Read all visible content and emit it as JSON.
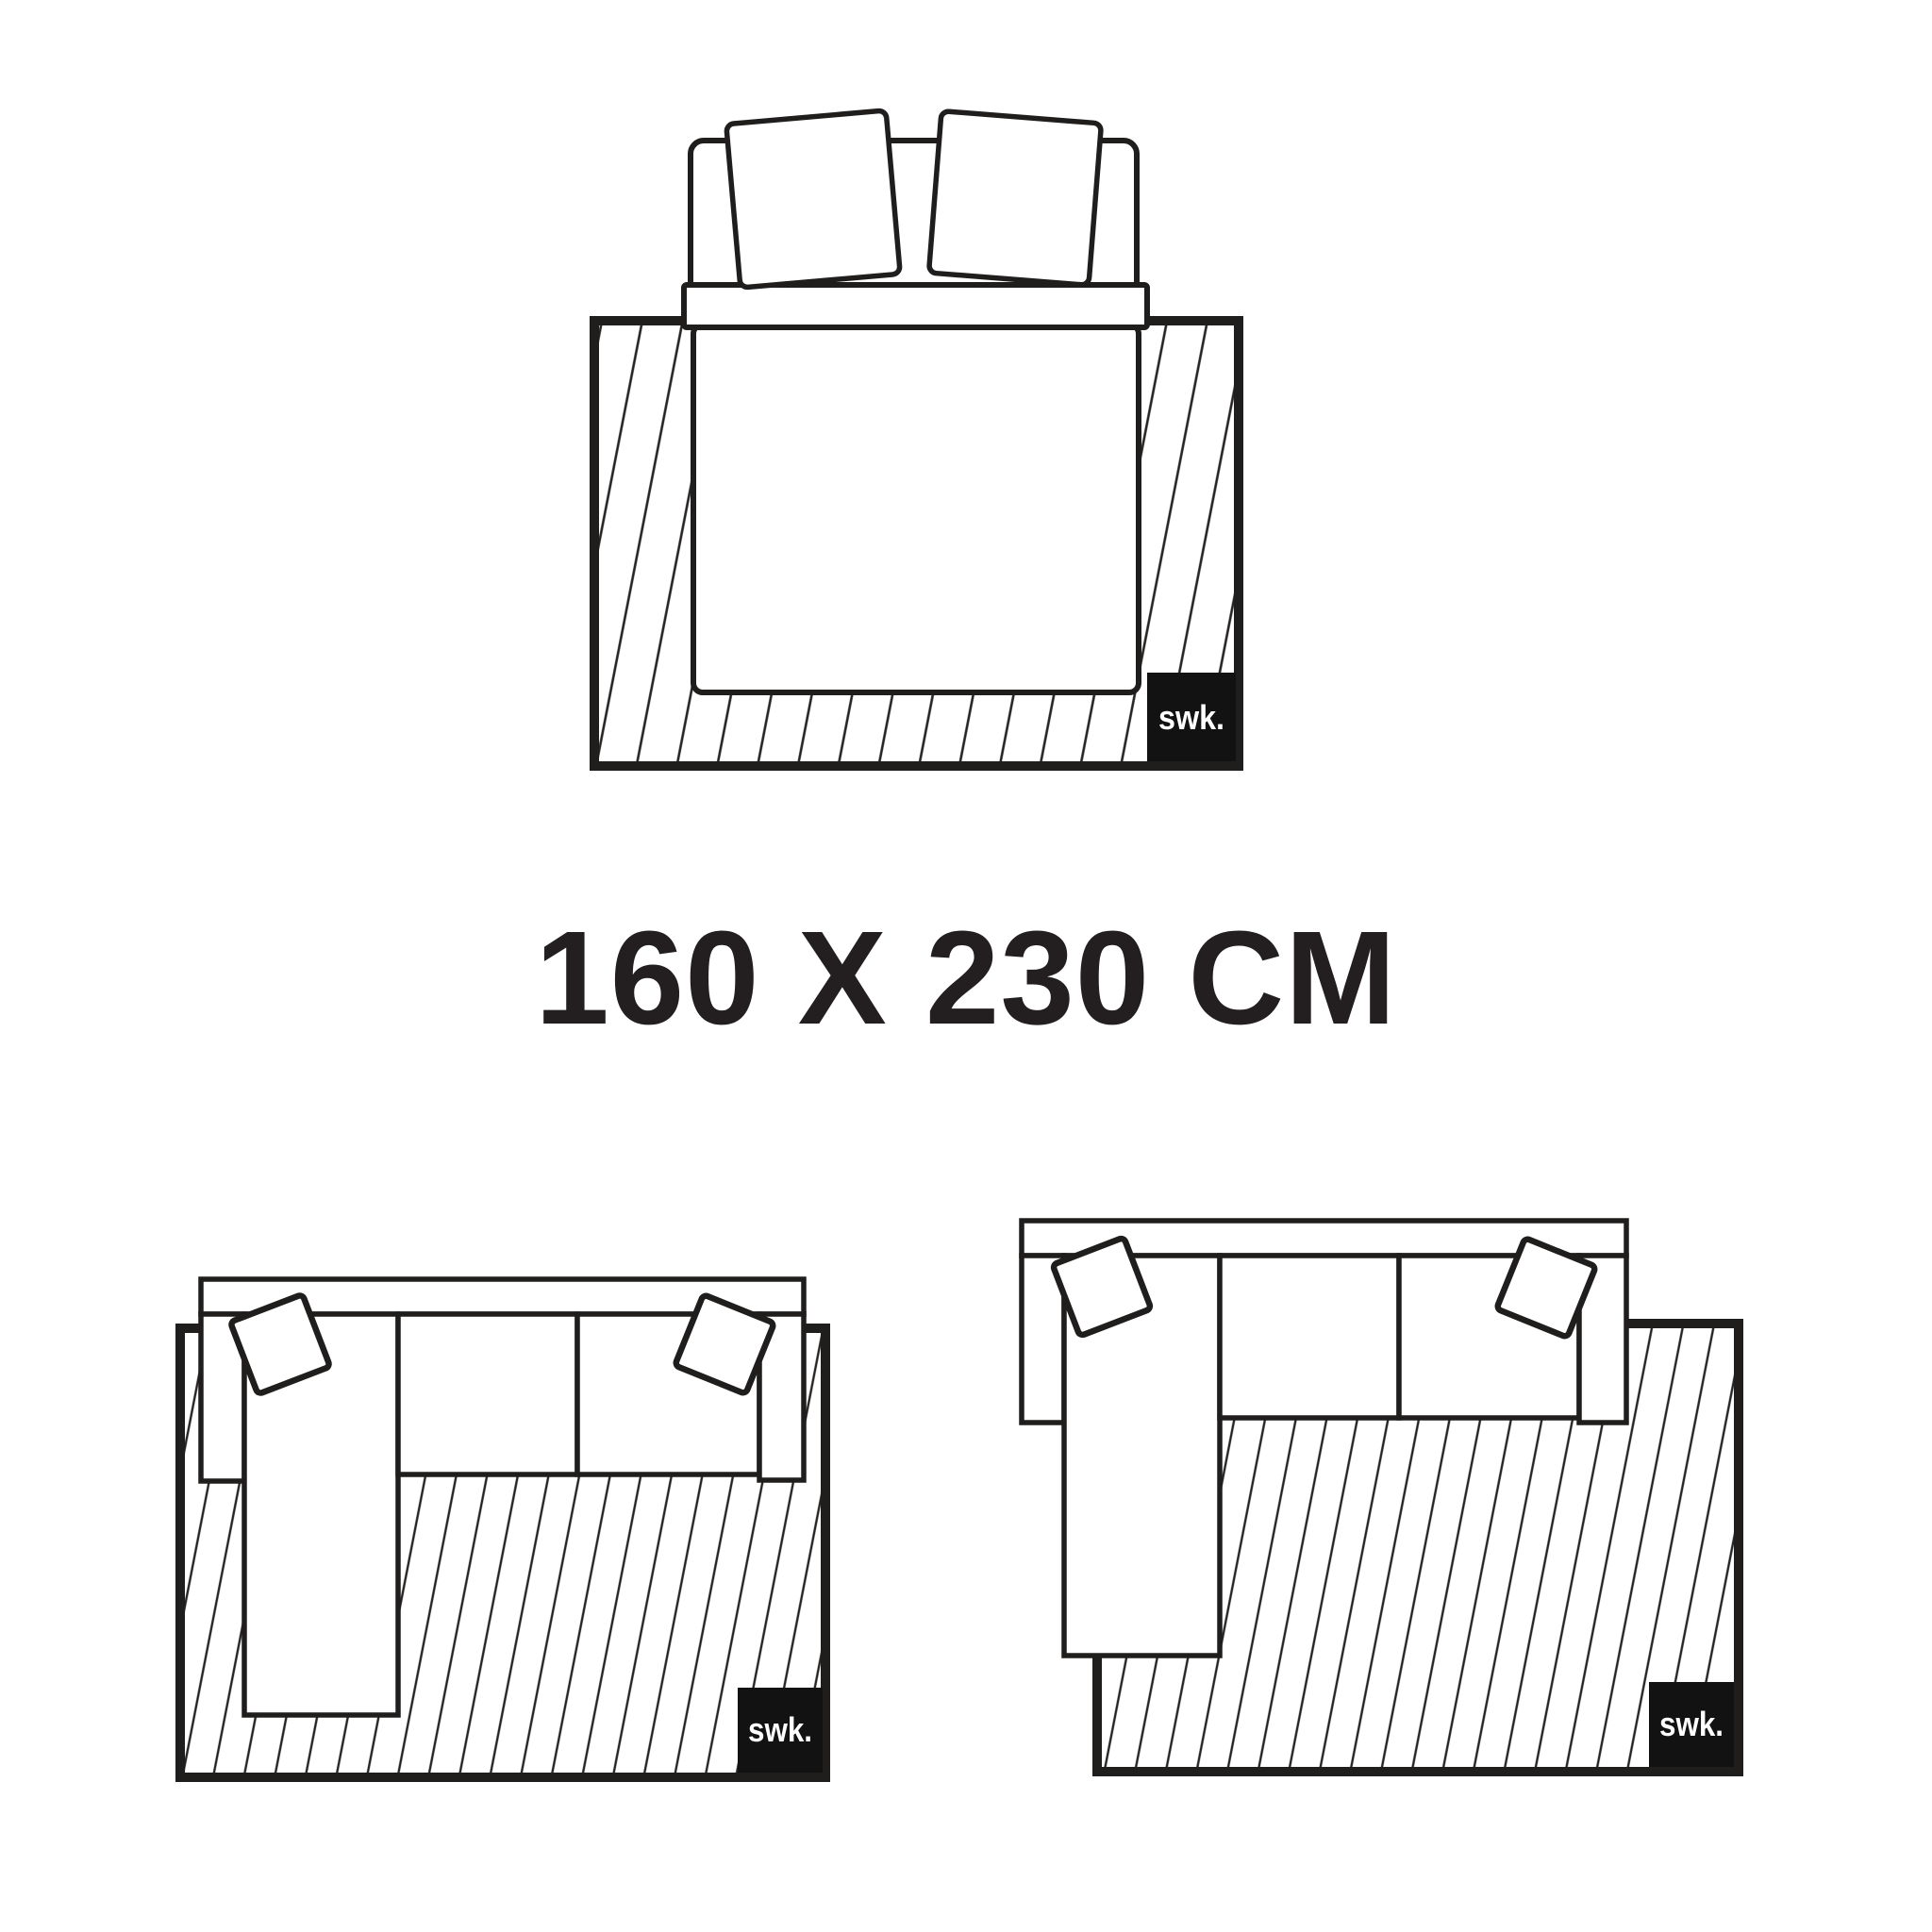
{
  "title": {
    "text": "160 X 230 CM"
  },
  "brand": {
    "logo_text": "swk."
  },
  "diagrams": [
    {
      "name": "bed-on-rug",
      "logo_text": "swk."
    },
    {
      "name": "sectional-sofa-left-chaise-on-rug",
      "logo_text": "swk."
    },
    {
      "name": "sectional-sofa-left-chaise-offset-rug",
      "logo_text": "swk."
    }
  ],
  "colors": {
    "bg": "#ffffff",
    "line": "#201d1d",
    "hatch": "#262323",
    "title": "#231f20",
    "badge-bg": "#121212",
    "badge-fg": "#ffffff"
  }
}
